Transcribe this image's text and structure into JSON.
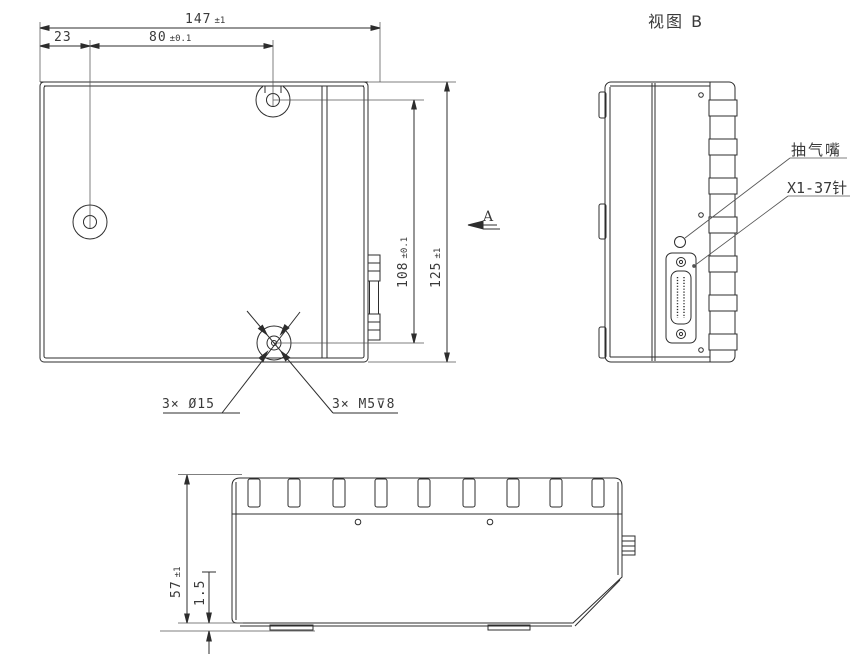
{
  "drawing": {
    "view_b_title": "视图 B",
    "dim_total_width": {
      "value": "147",
      "tol": "±1"
    },
    "dim_left_offset": {
      "value": "23",
      "tol": ""
    },
    "dim_hole_pitch_x": {
      "value": "80",
      "tol": "±0.1"
    },
    "dim_hole_pitch_y": {
      "value": "108",
      "tol": "±0.1"
    },
    "dim_total_height": {
      "value": "125",
      "tol": "±1"
    },
    "dim_side_height": {
      "value": "57",
      "tol": "±1"
    },
    "dim_base_thickness": {
      "value": "1.5",
      "tol": ""
    },
    "label_holes_cbore": "3× Ø15",
    "label_holes_thread": "3× M5⊽8",
    "label_view_arrow": "A",
    "label_nozzle": "抽气嘴",
    "label_connector": "X1-37针"
  },
  "colors": {
    "line": "#2d2d2d",
    "thin_line": "#555555",
    "background": "#ffffff",
    "text": "#3a3a3a"
  }
}
